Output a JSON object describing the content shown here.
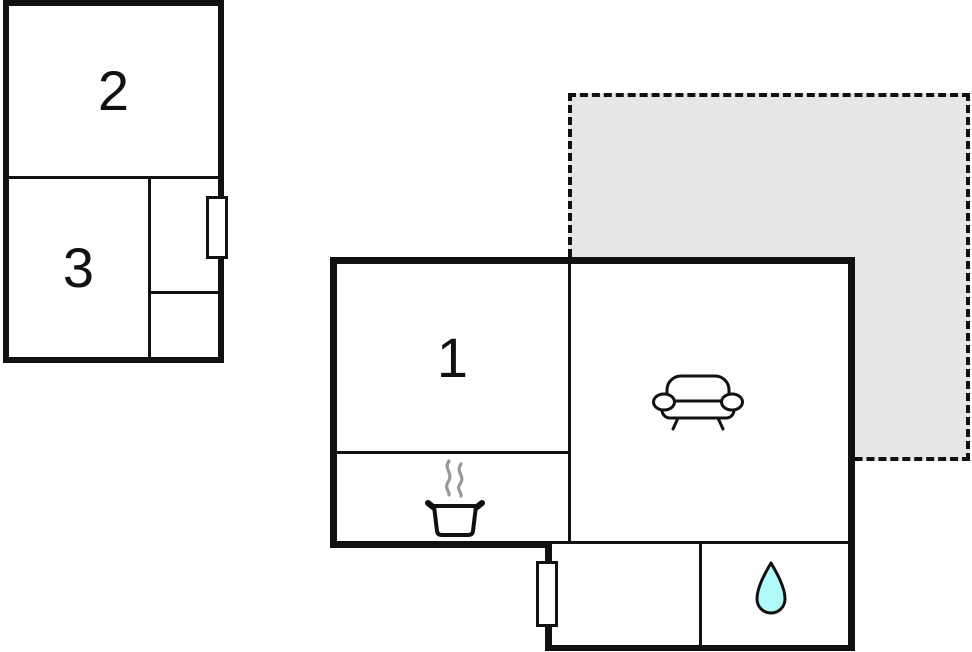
{
  "page": {
    "type": "floor-plan"
  },
  "colors": {
    "wall": "#111111",
    "background": "#ffffff",
    "terrace-fill": "#e6e6e6",
    "drop-fill": "#b2fafa",
    "steam": "#999999"
  },
  "rooms": {
    "room1": {
      "label": "1"
    },
    "room2": {
      "label": "2"
    },
    "room3": {
      "label": "3"
    }
  },
  "icons": {
    "sofa": "sofa-icon",
    "pot": "cooking-pot-icon",
    "drop": "water-drop-icon",
    "windows": "window"
  }
}
